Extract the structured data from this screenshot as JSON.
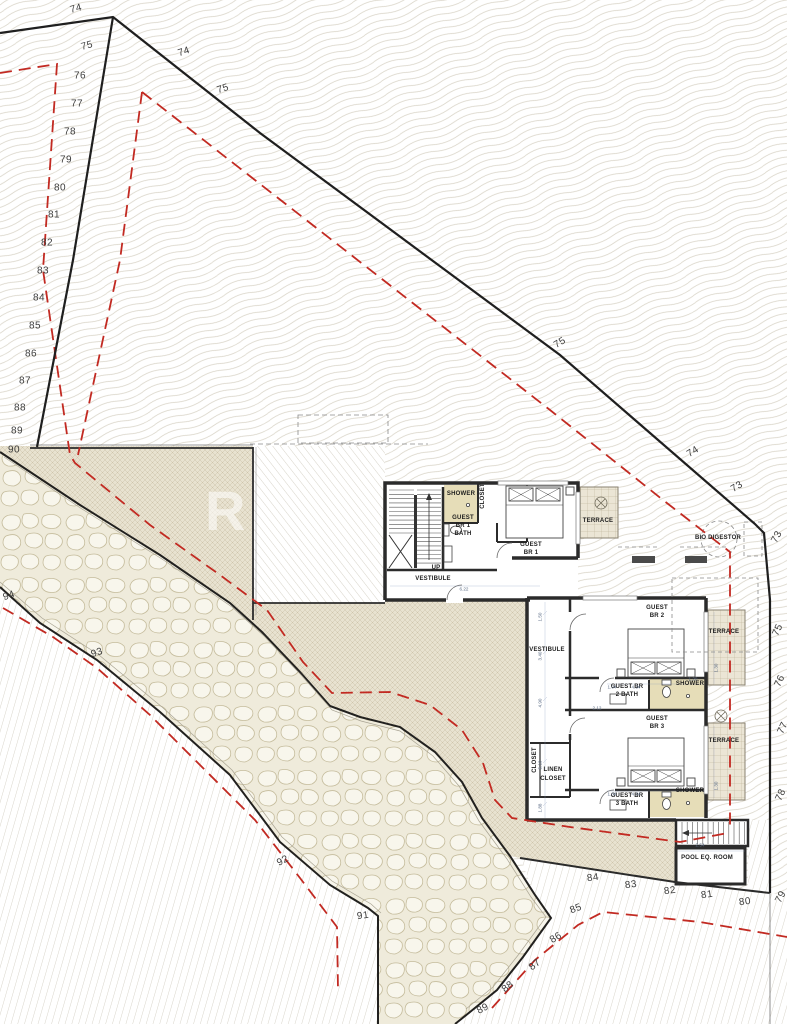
{
  "watermark": "R",
  "colors": {
    "property_line": "#1f1f1f",
    "setback_line": "#c22a22",
    "contour_line": "#d8d3c6",
    "deck_band": "#e8e2d0",
    "stone_joint": "#c5bc9c",
    "shower_fill": "#e6ddb8",
    "terrace_fill": "#ebe5d5",
    "wall": "#2b2b2b",
    "dimension_text": "#5a6b85"
  },
  "contour_labels": [
    {
      "t": "74",
      "x": 76,
      "y": 9,
      "r": -14
    },
    {
      "t": "75",
      "x": 87,
      "y": 46,
      "r": -14
    },
    {
      "t": "76",
      "x": 80,
      "y": 76,
      "r": 0
    },
    {
      "t": "77",
      "x": 77,
      "y": 104,
      "r": 0
    },
    {
      "t": "78",
      "x": 70,
      "y": 132,
      "r": 0
    },
    {
      "t": "79",
      "x": 66,
      "y": 160,
      "r": 0
    },
    {
      "t": "80",
      "x": 60,
      "y": 188,
      "r": 0
    },
    {
      "t": "81",
      "x": 54,
      "y": 215,
      "r": 0
    },
    {
      "t": "82",
      "x": 47,
      "y": 243,
      "r": 0
    },
    {
      "t": "83",
      "x": 43,
      "y": 271,
      "r": 0
    },
    {
      "t": "84",
      "x": 39,
      "y": 298,
      "r": 0
    },
    {
      "t": "85",
      "x": 35,
      "y": 326,
      "r": 0
    },
    {
      "t": "86",
      "x": 31,
      "y": 354,
      "r": 0
    },
    {
      "t": "87",
      "x": 25,
      "y": 381,
      "r": 0
    },
    {
      "t": "88",
      "x": 20,
      "y": 408,
      "r": 0
    },
    {
      "t": "89",
      "x": 17,
      "y": 431,
      "r": 0
    },
    {
      "t": "90",
      "x": 14,
      "y": 450,
      "r": 0
    },
    {
      "t": "74",
      "x": 184,
      "y": 52,
      "r": -18
    },
    {
      "t": "75",
      "x": 223,
      "y": 89,
      "r": -18
    },
    {
      "t": "75",
      "x": 560,
      "y": 343,
      "r": -32
    },
    {
      "t": "74",
      "x": 693,
      "y": 452,
      "r": -32
    },
    {
      "t": "73",
      "x": 737,
      "y": 487,
      "r": -32
    },
    {
      "t": "73",
      "x": 777,
      "y": 537,
      "r": -62
    },
    {
      "t": "75",
      "x": 778,
      "y": 630,
      "r": -65
    },
    {
      "t": "76",
      "x": 780,
      "y": 681,
      "r": -65
    },
    {
      "t": "77",
      "x": 783,
      "y": 728,
      "r": -65
    },
    {
      "t": "78",
      "x": 781,
      "y": 795,
      "r": -65
    },
    {
      "t": "94",
      "x": 9,
      "y": 596,
      "r": -18
    },
    {
      "t": "93",
      "x": 97,
      "y": 653,
      "r": -18
    },
    {
      "t": "92",
      "x": 283,
      "y": 861,
      "r": -28
    },
    {
      "t": "91",
      "x": 363,
      "y": 916,
      "r": -8
    },
    {
      "t": "84",
      "x": 593,
      "y": 878,
      "r": -8
    },
    {
      "t": "83",
      "x": 631,
      "y": 885,
      "r": -8
    },
    {
      "t": "82",
      "x": 670,
      "y": 891,
      "r": -8
    },
    {
      "t": "81",
      "x": 707,
      "y": 895,
      "r": -8
    },
    {
      "t": "80",
      "x": 745,
      "y": 902,
      "r": -8
    },
    {
      "t": "79",
      "x": 781,
      "y": 897,
      "r": -62
    },
    {
      "t": "85",
      "x": 576,
      "y": 909,
      "r": -22
    },
    {
      "t": "86",
      "x": 556,
      "y": 938,
      "r": -32
    },
    {
      "t": "87",
      "x": 535,
      "y": 965,
      "r": -38
    },
    {
      "t": "88",
      "x": 508,
      "y": 987,
      "r": -38
    },
    {
      "t": "89",
      "x": 483,
      "y": 1009,
      "r": -28
    }
  ],
  "room_labels": [
    {
      "t": "SHOWER",
      "x": 461,
      "y": 494
    },
    {
      "t": "GUEST",
      "x": 463,
      "y": 518
    },
    {
      "t": "BR 1",
      "x": 463,
      "y": 526
    },
    {
      "t": "BATH",
      "x": 463,
      "y": 534
    },
    {
      "t": "CLOSET",
      "x": 483,
      "y": 496,
      "r": -90
    },
    {
      "t": "GUEST",
      "x": 531,
      "y": 545
    },
    {
      "t": "BR 1",
      "x": 531,
      "y": 553
    },
    {
      "t": "TERRACE",
      "x": 598,
      "y": 521
    },
    {
      "t": "UP",
      "x": 436,
      "y": 568
    },
    {
      "t": "VESTIBULE",
      "x": 433,
      "y": 579
    },
    {
      "t": "VESTIBULE",
      "x": 547,
      "y": 650
    },
    {
      "t": "GUEST",
      "x": 657,
      "y": 608
    },
    {
      "t": "BR 2",
      "x": 657,
      "y": 616
    },
    {
      "t": "TERRACE",
      "x": 724,
      "y": 632
    },
    {
      "t": "GUEST BR",
      "x": 627,
      "y": 687
    },
    {
      "t": "2 BATH",
      "x": 627,
      "y": 695
    },
    {
      "t": "SHOWER",
      "x": 690,
      "y": 684
    },
    {
      "t": "GUEST",
      "x": 657,
      "y": 719
    },
    {
      "t": "BR 3",
      "x": 657,
      "y": 727
    },
    {
      "t": "TERRACE",
      "x": 724,
      "y": 741
    },
    {
      "t": "GUEST BR",
      "x": 627,
      "y": 796
    },
    {
      "t": "3 BATH",
      "x": 627,
      "y": 804
    },
    {
      "t": "SHOWER",
      "x": 690,
      "y": 791
    },
    {
      "t": "LINEN",
      "x": 553,
      "y": 770
    },
    {
      "t": "CLOSET",
      "x": 553,
      "y": 779
    },
    {
      "t": "CLOSET",
      "x": 535,
      "y": 760,
      "r": -90
    },
    {
      "t": "POOL EQ. ROOM",
      "x": 707,
      "y": 858
    },
    {
      "t": "BIO DIGESTOR",
      "x": 718,
      "y": 538
    }
  ],
  "dimension_labels": [
    {
      "t": "6.22",
      "x": 464,
      "y": 589
    },
    {
      "t": "2.54",
      "x": 700,
      "y": 845
    },
    {
      "t": "1.50",
      "x": 540,
      "y": 617,
      "r": -90
    },
    {
      "t": "3.40",
      "x": 540,
      "y": 656,
      "r": -90
    },
    {
      "t": "4.90",
      "x": 540,
      "y": 703,
      "r": -90
    },
    {
      "t": "5.10",
      "x": 540,
      "y": 765,
      "r": -90
    },
    {
      "t": "1.88",
      "x": 540,
      "y": 808,
      "r": -90
    },
    {
      "t": "2.12",
      "x": 597,
      "y": 708
    },
    {
      "t": "1.04",
      "x": 612,
      "y": 687
    },
    {
      "t": "4.34",
      "x": 636,
      "y": 687
    },
    {
      "t": "1.20",
      "x": 693,
      "y": 679
    },
    {
      "t": "1.30",
      "x": 716,
      "y": 668,
      "r": -90
    },
    {
      "t": "1.30",
      "x": 716,
      "y": 786,
      "r": -90
    },
    {
      "t": "1.04",
      "x": 612,
      "y": 794
    },
    {
      "t": "4.34",
      "x": 636,
      "y": 794
    }
  ]
}
